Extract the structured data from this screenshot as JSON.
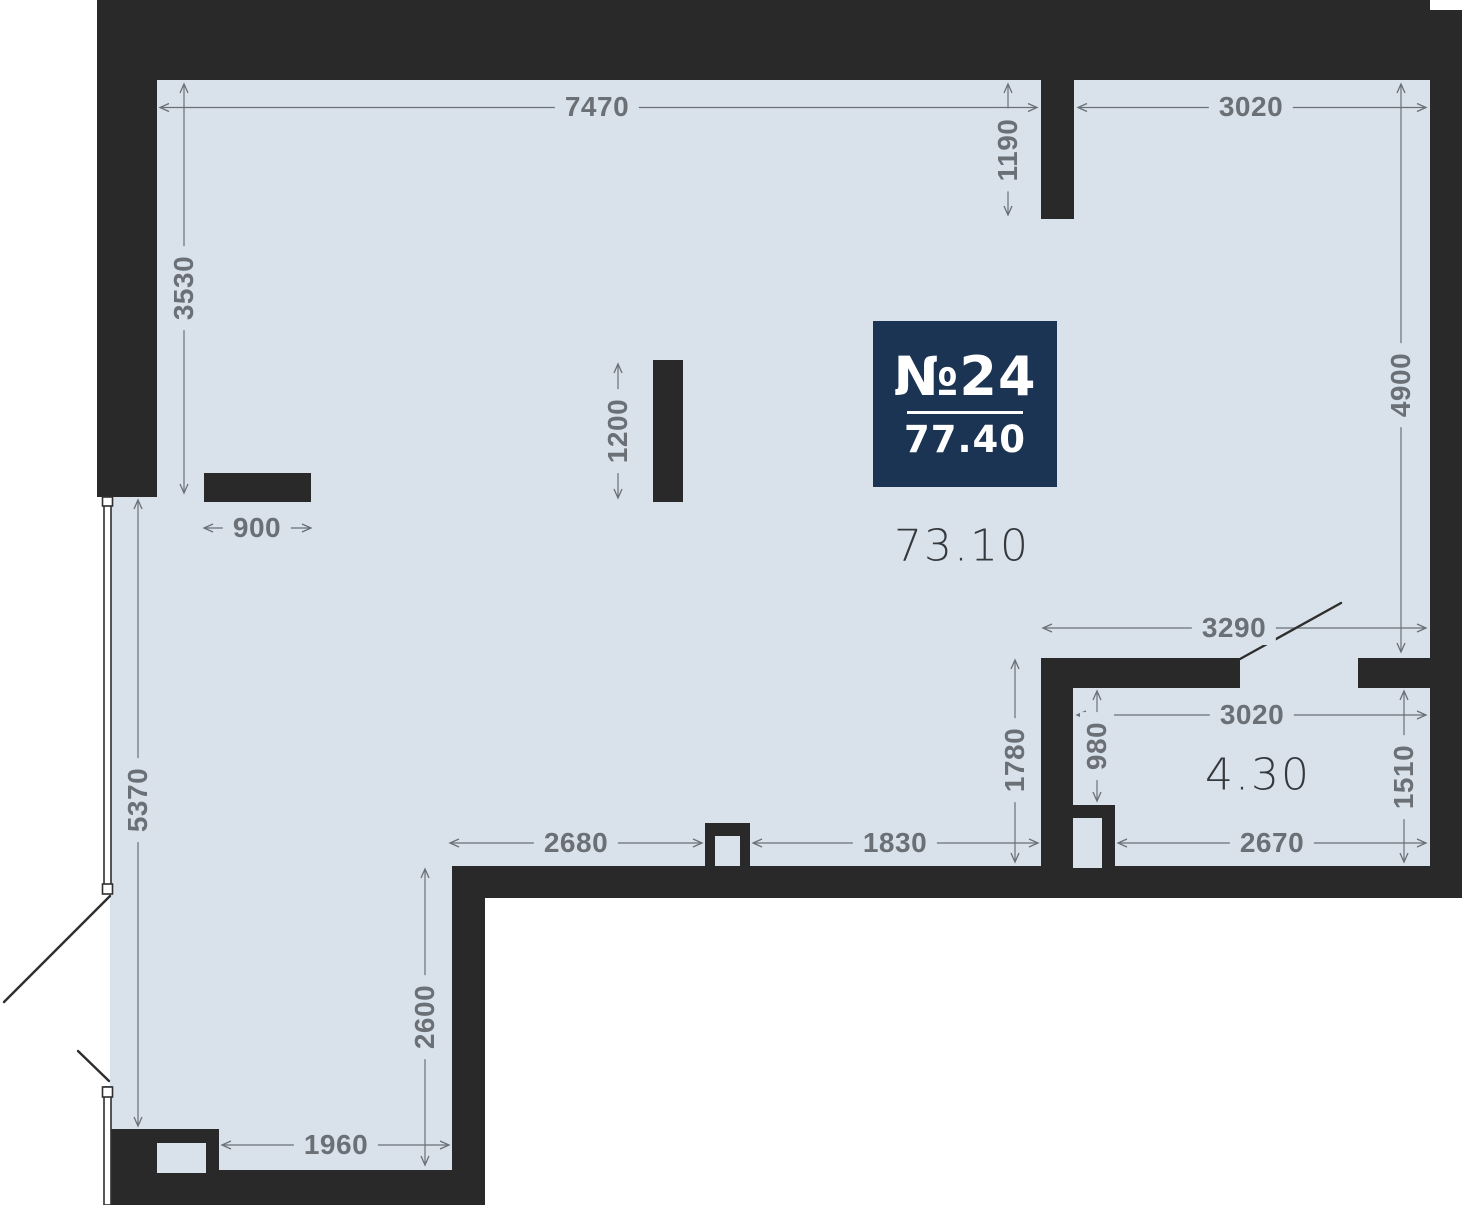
{
  "plan": {
    "badge": {
      "unit_number": "№24",
      "area_total": "77.40"
    },
    "room_areas": {
      "main": "73.10",
      "balcony": "4.30"
    },
    "dimensions": {
      "top_left_width": "7470",
      "top_right_width": "3020",
      "niche_depth": "1190",
      "left_upper_height": "3530",
      "right_height": "4900",
      "partition_length": "1200",
      "shelf_width": "900",
      "opening_width": "3290",
      "hall_height": "1780",
      "balcony_width": "3020",
      "balcony_door_offset": "980",
      "balcony_right_height": "1510",
      "bottom_left_width": "2680",
      "bottom_mid_width": "1830",
      "balcony_bottom_width": "2670",
      "left_lower_height": "5370",
      "leg_height": "2600",
      "leg_bottom_width": "1960"
    },
    "colors": {
      "background": "#ffffff",
      "wall": "#292929",
      "floor": "#d9e2eb",
      "badge_bg": "#1c3454",
      "badge_text": "#ffffff",
      "dimension_text": "#6b7076",
      "area_text": "#35383c"
    }
  }
}
